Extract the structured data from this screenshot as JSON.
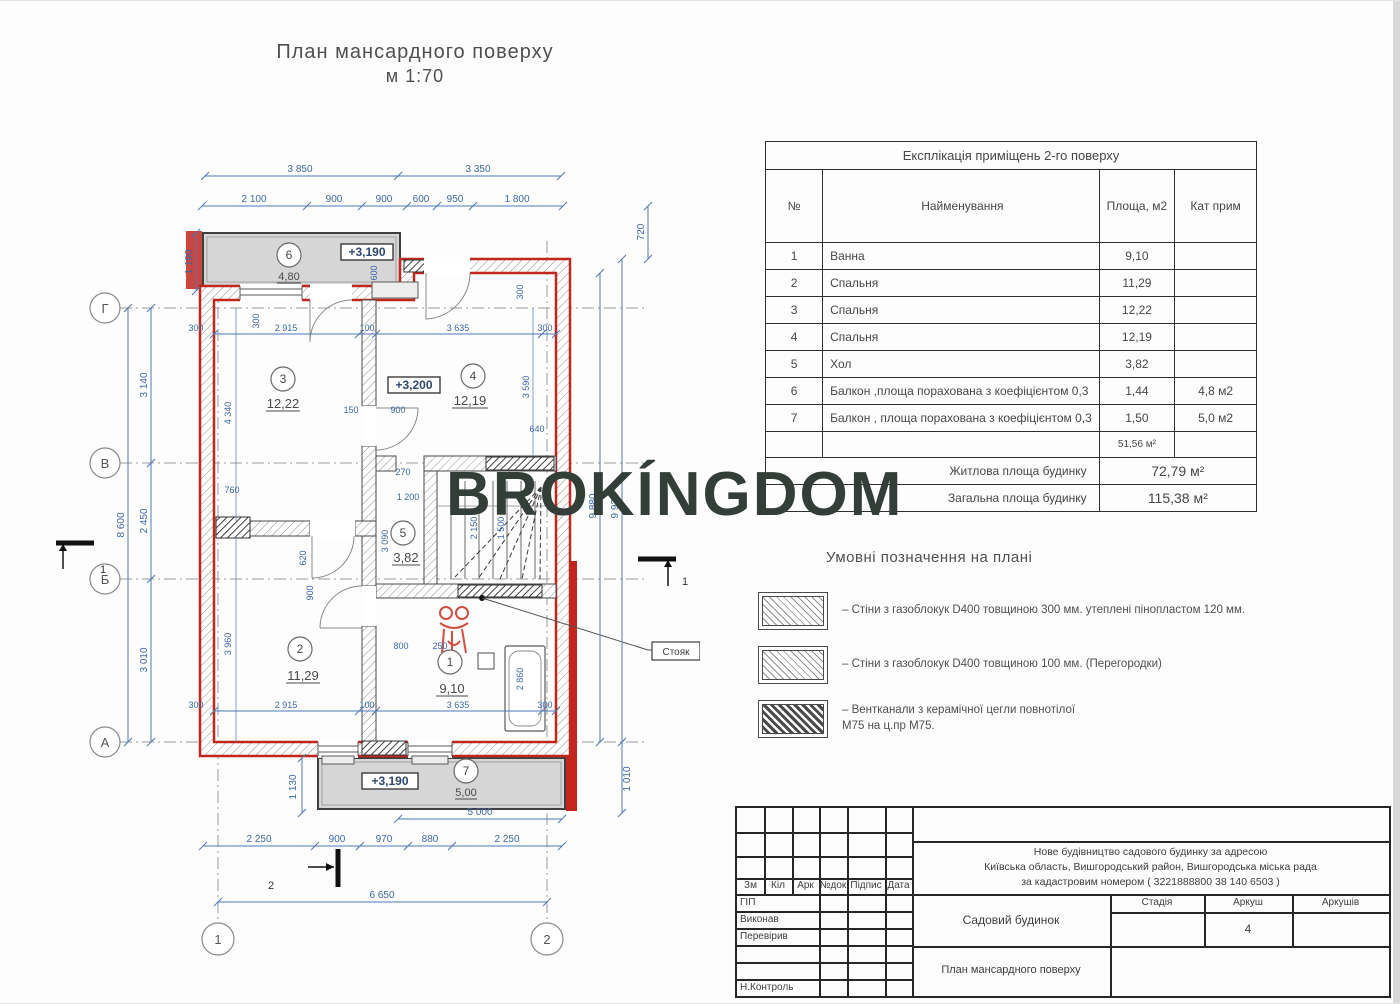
{
  "page": {
    "title_line1": "План мансардного поверху",
    "title_line2": "м 1:70"
  },
  "watermark": "BROKÍNGDOM",
  "colors": {
    "wall_red": "#c2261d",
    "dim_blue": "#3c67a8",
    "balcony_gray": "#d6d6d6",
    "watermark": "#343e39"
  },
  "plan": {
    "axes": {
      "g": "Г",
      "v": "В",
      "b": "Б",
      "a": "А",
      "c1": "1",
      "c2": "2"
    },
    "sections": {
      "s1": "1",
      "s2": "2"
    },
    "riser_label": "Стояк",
    "rooms": {
      "r1": {
        "num": "1",
        "area": "9,10"
      },
      "r2": {
        "num": "2",
        "area": "11,29"
      },
      "r3": {
        "num": "3",
        "area": "12,22"
      },
      "r4": {
        "num": "4",
        "area": "12,19"
      },
      "r5": {
        "num": "5",
        "area": "3,82"
      },
      "r6": {
        "num": "6",
        "area": "4,80"
      },
      "r7": {
        "num": "7",
        "area": "5,00"
      }
    },
    "elevations": {
      "e1": "+3,190",
      "e2": "+3,200",
      "e3": "+3,190"
    },
    "dims": {
      "t1a": "3 850",
      "t1b": "3 350",
      "t2a": "2 100",
      "t2b": "900",
      "t2c": "900",
      "t2d": "600",
      "t2e": "950",
      "t2f": "1 800",
      "l1": "8 600",
      "l2": "3 140",
      "l3": "2 450",
      "l4": "3 010",
      "l5": "1 190",
      "r1": "720",
      "r2": "9 880",
      "r3": "9 920",
      "r4": "1 010",
      "b1": "5 000",
      "b2": "2 250",
      "b3": "900",
      "b4": "970",
      "b5": "880",
      "b6": "2 250",
      "b7": "6 650",
      "b8": "1 130",
      "i1": "300",
      "i2": "2 915",
      "i3": "100",
      "i4": "3 635",
      "i5": "300",
      "i6": "4 340",
      "i7": "3 590",
      "i8": "640",
      "i9": "150",
      "i10": "900",
      "i11": "600",
      "i12": "300",
      "i13": "270",
      "i14": "1 200",
      "i15": "2 150",
      "i16": "1 500",
      "i17": "3 090",
      "i18": "620",
      "i19": "900",
      "i20": "760",
      "i21": "3 960",
      "i22": "800",
      "i23": "250",
      "i24": "2 860",
      "i25": "2 915",
      "i26": "100",
      "i27": "3 635",
      "i28": "300",
      "i29": "300",
      "i30": "300"
    }
  },
  "table": {
    "title": "Експлікація приміщень 2-го поверху",
    "headers": {
      "num": "№",
      "name": "Найменування",
      "area": "Площа, м2",
      "note": "Кат прим"
    },
    "rows": [
      {
        "num": "1",
        "name": "Ванна",
        "area": "9,10",
        "note": ""
      },
      {
        "num": "2",
        "name": "Спальня",
        "area": "11,29",
        "note": ""
      },
      {
        "num": "3",
        "name": "Спальня",
        "area": "12,22",
        "note": ""
      },
      {
        "num": "4",
        "name": "Спальня",
        "area": "12,19",
        "note": ""
      },
      {
        "num": "5",
        "name": "Хол",
        "area": "3,82",
        "note": ""
      },
      {
        "num": "6",
        "name": "Балкон ,площа порахована з коефіцієнтом 0,3",
        "area": "1,44",
        "note": "4,8 м2"
      },
      {
        "num": "7",
        "name": "Балкон , площа порахована з коефіцієнтом 0,3",
        "area": "1,50",
        "note": "5,0 м2"
      }
    ],
    "subtotal_area": "51,56 м²",
    "summary": [
      {
        "label": "Житлова площа будинку",
        "value": "72,79 м²"
      },
      {
        "label": "Загальна площа  будинку",
        "value": "115,38 м²"
      }
    ]
  },
  "legend": {
    "heading": "Умовні позначення на плані",
    "items": [
      {
        "text": "–  Стіни з газоблокук D400 товщиною 300 мм. утеплені пінопластом 120 мм.",
        "text2": ""
      },
      {
        "text": "–  Стіни з газоблокук D400 товщиною 100 мм. (Перегородки)",
        "text2": ""
      },
      {
        "text": "–  Вентканали з керамічної цегли  повнотілої",
        "text2": "М75 на ц.пр М75."
      }
    ]
  },
  "title_block": {
    "sig_cols": [
      "Зм",
      "Кіл",
      "Арк",
      "№док",
      "Підпис",
      "Дата"
    ],
    "sig_rows": [
      "ГІП",
      "Виконав",
      "Перевірив",
      "Н.Контроль"
    ],
    "address_lines": [
      "Нове будівництво  садового будинку за адресою",
      "Київська область, Вишгородський  район,  Вишгородська міська рада",
      "за кадастровим номером ( 3221888800 38 140 6503 )"
    ],
    "object_name": "Садовий будинок",
    "sheet_title": "План мансардного поверху",
    "stage_label": "Стадія",
    "sheet_label": "Аркуш",
    "sheets_label": "Аркушів",
    "sheet_number": "4"
  }
}
